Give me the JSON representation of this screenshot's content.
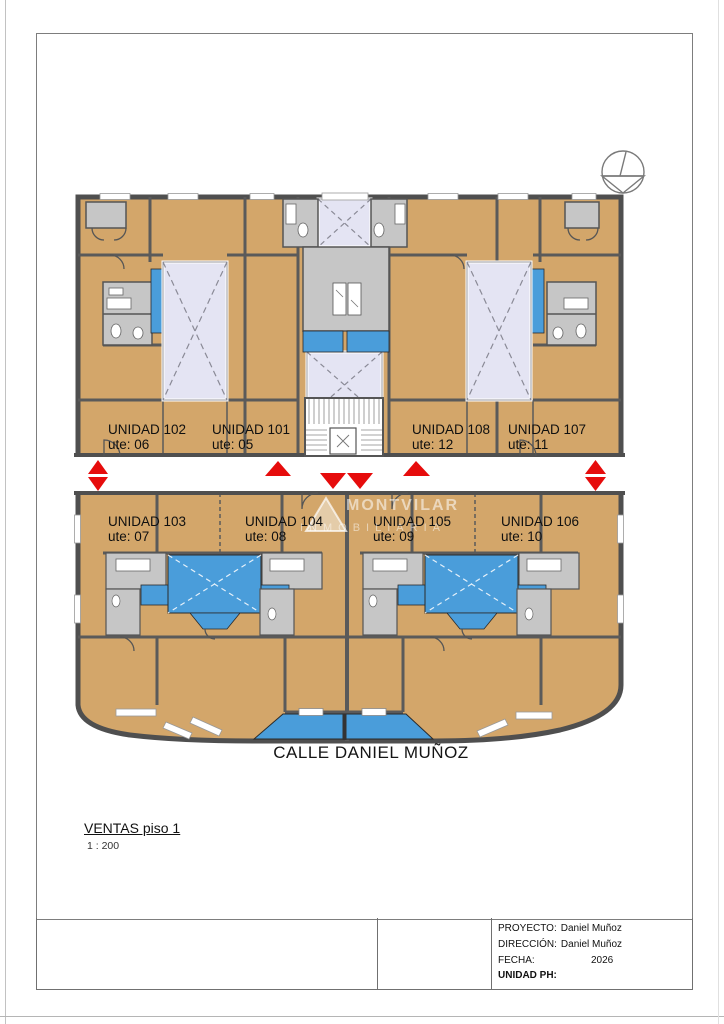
{
  "drawing": {
    "title": "VENTAS piso 1",
    "scale": "1 : 200",
    "street_label": "CALLE DANIEL MUÑOZ",
    "watermark_line1": "MONTVILAR",
    "watermark_line2": "INMOBILIARIA"
  },
  "units": [
    {
      "name": "UNIDAD 102",
      "ute": "ute: 06"
    },
    {
      "name": "UNIDAD 101",
      "ute": "ute: 05"
    },
    {
      "name": "UNIDAD 108",
      "ute": "ute: 12"
    },
    {
      "name": "UNIDAD 107",
      "ute": "ute: 11"
    },
    {
      "name": "UNIDAD 103",
      "ute": "ute: 07"
    },
    {
      "name": "UNIDAD 104",
      "ute": "ute: 08"
    },
    {
      "name": "UNIDAD 105",
      "ute": "ute: 09"
    },
    {
      "name": "UNIDAD 106",
      "ute": "ute: 10"
    }
  ],
  "title_block": {
    "project_label": "PROYECTO:",
    "project_value": "Daniel Muñoz",
    "address_label": "DIRECCIÓN:",
    "address_value": "Daniel Muñoz",
    "date_label": "FECHA:",
    "date_value": "2026",
    "unit_ph_label": "UNIDAD PH:"
  },
  "colors": {
    "room_tan": "#d3a66a",
    "wall_gray": "#4f4f4f",
    "service_gray": "#c6c6c6",
    "lightwell_lavender": "#e4e4f3",
    "glazing_blue": "#4a9dda",
    "arrow_red": "#e60c0c"
  }
}
